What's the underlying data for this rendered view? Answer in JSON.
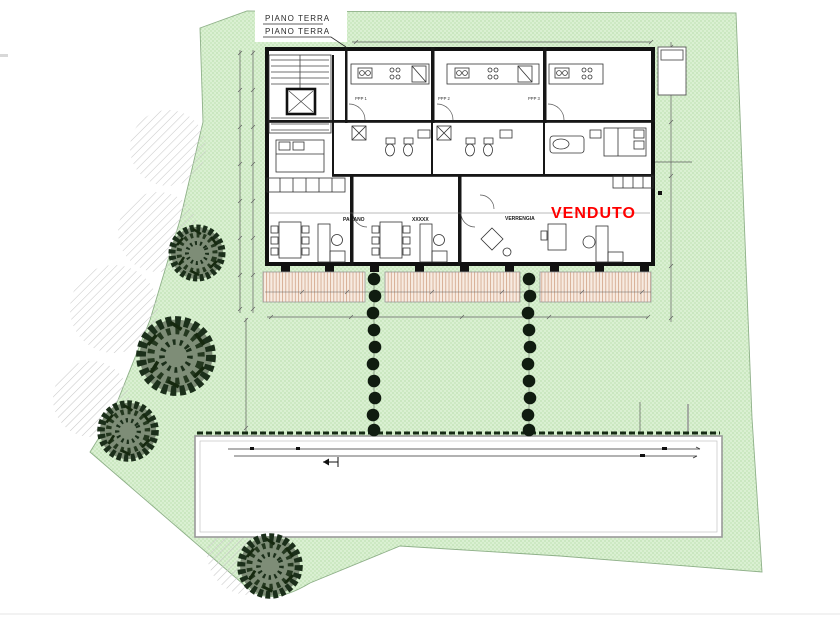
{
  "plan": {
    "title_label_1": "PIANO TERRA",
    "title_label_2": "PIANO TERRA",
    "units": [
      {
        "code": "PPP 1",
        "owner": "PAGANO",
        "status": ""
      },
      {
        "code": "PPP 2",
        "owner": "XXXXX",
        "status": ""
      },
      {
        "code": "PPP 3",
        "owner": "VERRENGIA",
        "status": "VENDUTO"
      }
    ],
    "sold_label": "VENDUTO",
    "icons": {
      "tree": "tree-symbol",
      "bush": "bush-symbol",
      "canopy": "canopy-hatch-circle",
      "entry_arrow": "entry-arrow-icon"
    },
    "colors": {
      "lawn": "#daf0d2",
      "lawn_dots": "#a9d59b",
      "lawn_border": "#8fb089",
      "terrace_bg": "#f7ebe1",
      "terrace_lines": "#d2a488",
      "wall_black": "#111111",
      "tree_dark": "#1b2f1a",
      "tree_fill": "#7e8d77",
      "bush_dark": "#101c10",
      "hatch_gray": "#c9c9c9",
      "dim_line": "#606060",
      "sold_red": "#ff0000",
      "driveway_border": "#999999"
    }
  }
}
